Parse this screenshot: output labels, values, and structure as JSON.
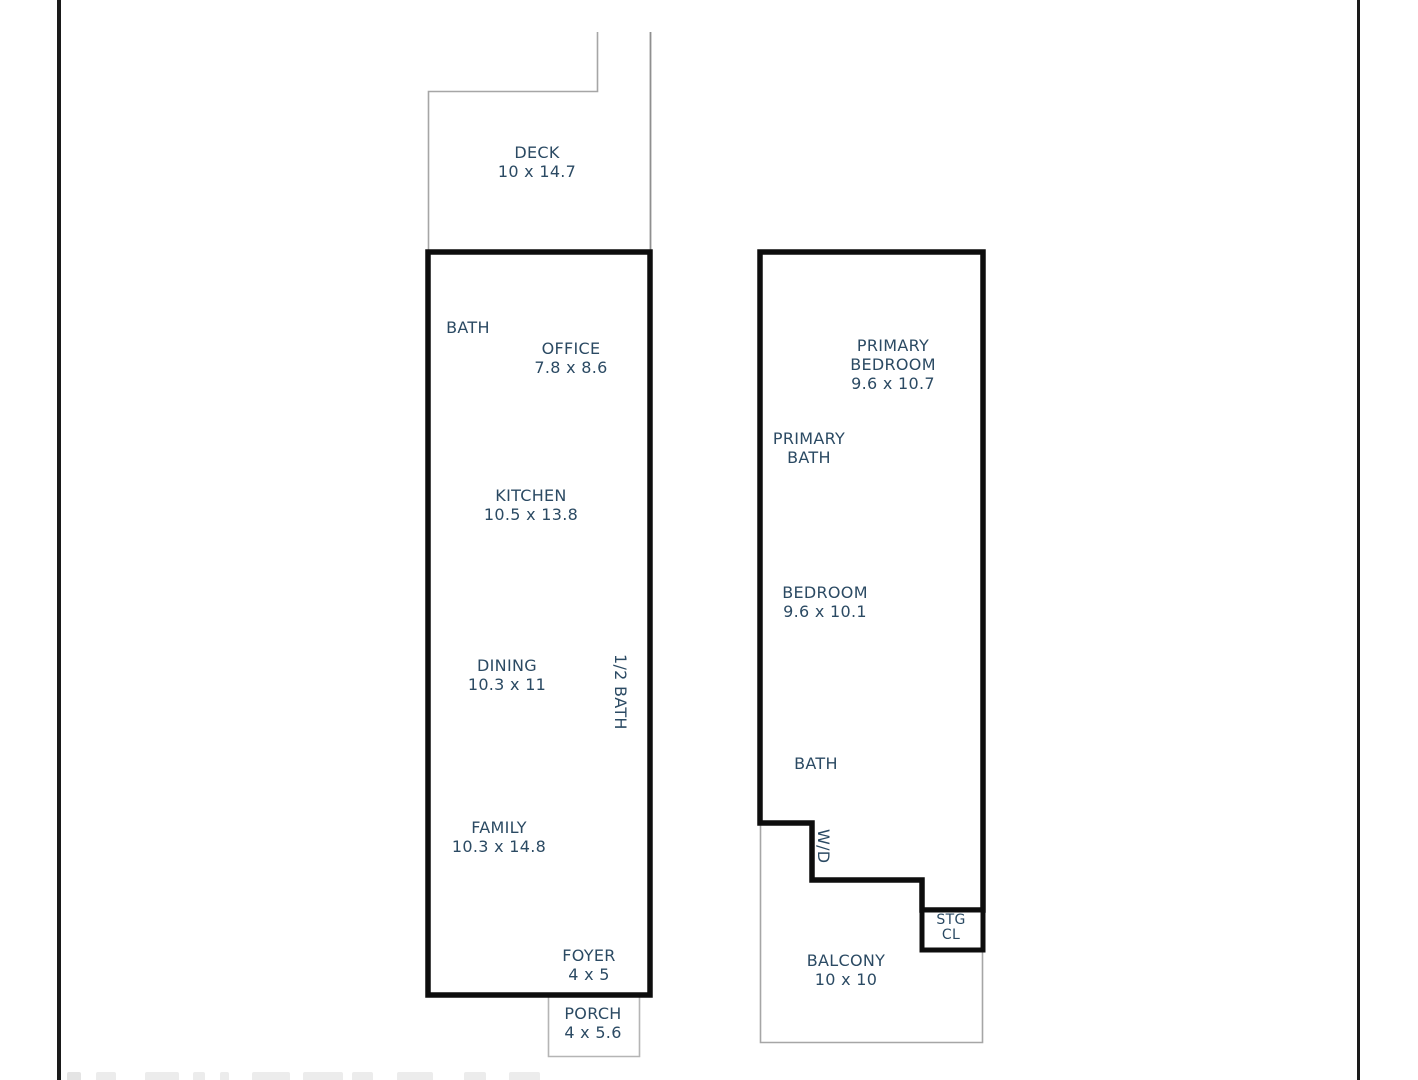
{
  "palette": {
    "wall_color": "#0d0d0d",
    "thin_line_color": "#a6a6a6",
    "label_color": "#2b4a63",
    "frame_line_color": "#1a1a1a",
    "background": "#ffffff"
  },
  "floor_plan": {
    "left_unit": {
      "deck": {
        "name": "DECK",
        "dims": "10 x 14.7"
      },
      "bath": {
        "name": "BATH"
      },
      "office": {
        "name": "OFFICE",
        "dims": "7.8 x 8.6"
      },
      "kitchen": {
        "name": "KITCHEN",
        "dims": "10.5 x 13.8"
      },
      "dining": {
        "name": "DINING",
        "dims": "10.3 x 11"
      },
      "half_bath": {
        "name": "1/2 BATH"
      },
      "family": {
        "name": "FAMILY",
        "dims": "10.3 x 14.8"
      },
      "foyer": {
        "name": "FOYER",
        "dims": "4 x 5"
      },
      "porch": {
        "name": "PORCH",
        "dims": "4 x 5.6"
      }
    },
    "right_unit": {
      "primary_bedroom": {
        "name_line_1": "PRIMARY",
        "name_line_2": "BEDROOM",
        "dims": "9.6 x 10.7"
      },
      "primary_bath": {
        "name_line_1": "PRIMARY",
        "name_line_2": "BATH"
      },
      "bedroom": {
        "name": "BEDROOM",
        "dims": "9.6 x 10.1"
      },
      "bath": {
        "name": "BATH"
      },
      "washer_dryer": {
        "name": "W/D"
      },
      "storage_closet": {
        "name_line_1": "STG",
        "name_line_2": "CL"
      },
      "balcony": {
        "name": "BALCONY",
        "dims": "10 x 10"
      }
    }
  }
}
